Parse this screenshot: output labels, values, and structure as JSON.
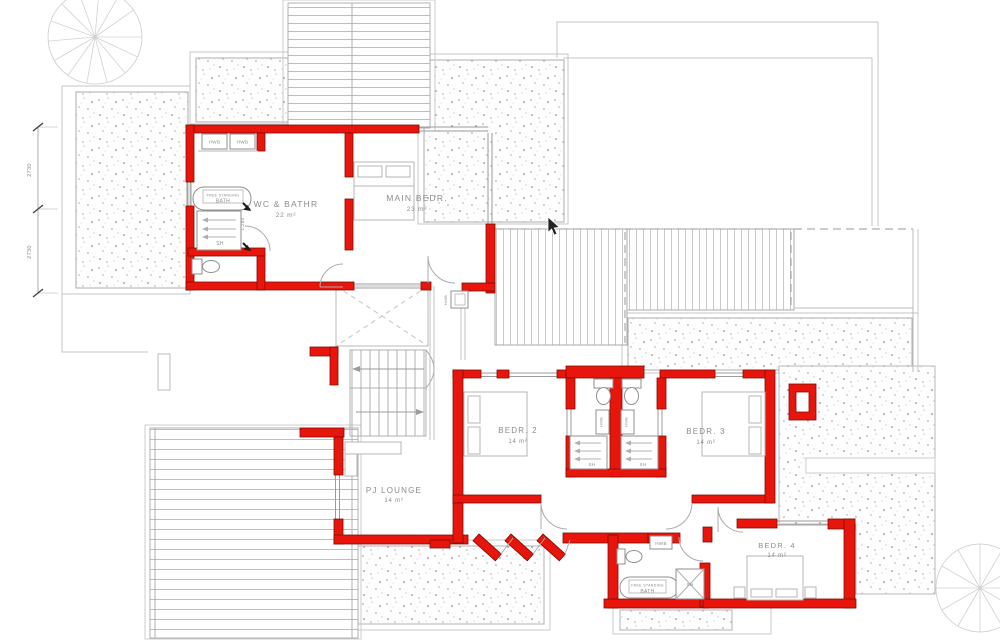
{
  "plan": {
    "rooms": [
      {
        "id": "wc-bathr",
        "name": "WC & BATHR",
        "area": "22 m²"
      },
      {
        "id": "main-bedr",
        "name": "MAIN BEDR.",
        "area": "23 m²"
      },
      {
        "id": "bedr-2",
        "name": "BEDR. 2",
        "area": "14 m²"
      },
      {
        "id": "bedr-3",
        "name": "BEDR. 3",
        "area": "14 m²"
      },
      {
        "id": "bedr-4",
        "name": "BEDR. 4",
        "area": "14 m²"
      },
      {
        "id": "pj-lounge",
        "name": "PJ LOUNGE",
        "area": "14 m²"
      }
    ],
    "fixtures": {
      "hwb": "HWB",
      "sh": "SH",
      "bath_line1": "FREE STANDING",
      "bath_line2": "BATH"
    },
    "dimensions": {
      "left_upper": "2730",
      "left_lower": "2730",
      "bath_door": "1,280"
    },
    "colors": {
      "wall": "#e8150c",
      "wall_outline": "#7e0d06",
      "annotation_gray": "#8c8c8c",
      "line_gray": "#b0b0b0"
    }
  }
}
